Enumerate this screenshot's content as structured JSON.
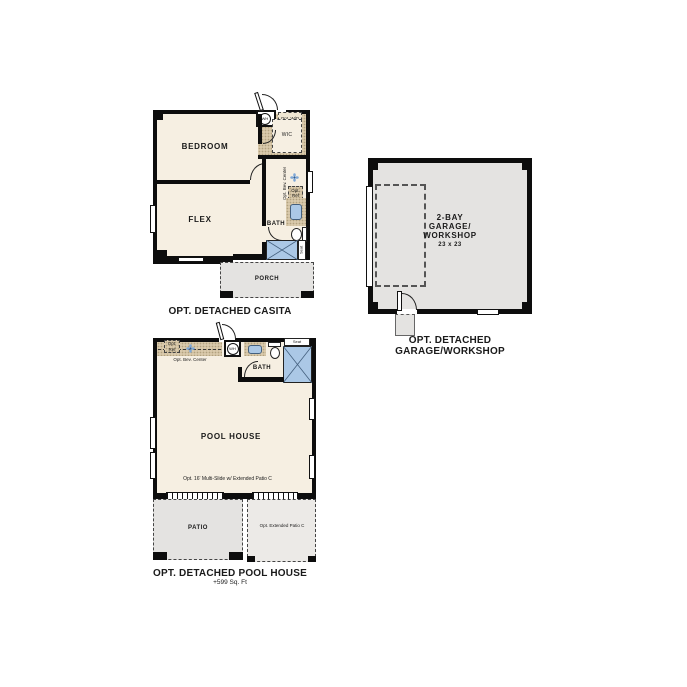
{
  "colors": {
    "background": "#ffffff",
    "wall": "#0d0d0d",
    "room": "#f6efe2",
    "tan": "#d9c9ab",
    "gray": "#e4e3e1",
    "fixture_blue": "#abc8e6"
  },
  "icons": {
    "fan": "fan-icon",
    "shower": "shower-x-icon",
    "toilet": "toilet-icon",
    "sink": "sink-icon",
    "water_heater": "wh-circle-icon"
  },
  "casita": {
    "caption": "OPT. DETACHED CASITA",
    "bedroom_label": "BEDROOM",
    "flex_label": "FLEX",
    "bath_label": "BATH",
    "wic_label": "WIC",
    "porch_label": "PORCH",
    "wh_label": "WH",
    "opt_wd_label": "Opt. W/D",
    "opt_bev_center_label": "Opt. Bev. Center",
    "opt_ref_label": "Opt. Ref",
    "seat_label": "Seat"
  },
  "garage": {
    "caption": "OPT. DETACHED GARAGE/WORKSHOP",
    "name_line1": "2-BAY",
    "name_line2": "GARAGE/",
    "name_line3": "WORKSHOP",
    "dimension": "23 x 23"
  },
  "pool_house": {
    "caption": "OPT. DETACHED POOL HOUSE",
    "area": "+599 Sq. Ft",
    "main_label": "POOL HOUSE",
    "bath_label": "BATH",
    "patio_label": "PATIO",
    "ext_patio_label": "Opt. Extended Patio C",
    "wh_label": "WH",
    "opt_ref_label": "Opt. Ref",
    "opt_bev_center_label": "Opt. Bev. Center",
    "seat_label": "Seat",
    "multi_slide_label": "Opt. 16' Multi-Slide w/ Extended Patio C"
  }
}
